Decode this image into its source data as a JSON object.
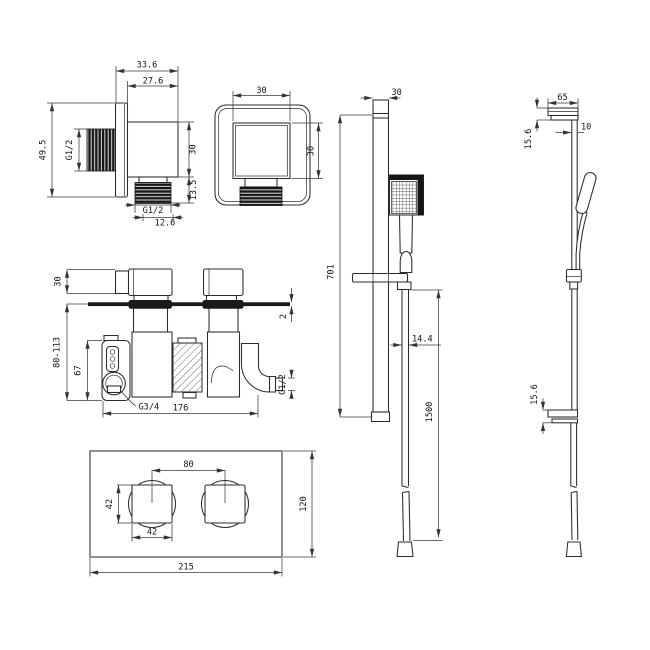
{
  "drawing": {
    "background": "#ffffff",
    "ink": "#2b2b2b",
    "views": {
      "outlet_side": {
        "overall_width": "33.6",
        "body_width": "27.6",
        "flange_height": "49.5",
        "inlet_thread": "G1/2",
        "body_height": "30",
        "thread_length": "13.5",
        "outlet_thread": "G1/2",
        "outlet_core": "12.6"
      },
      "outlet_front": {
        "face_width": "30",
        "face_height": "30"
      },
      "valve": {
        "handle_depth": "30",
        "install_depth": "80-113",
        "body_height": "67",
        "plate_thickness": "2",
        "outlet_thread": "G1/2",
        "inlet_thread": "G3/4",
        "body_width": "176"
      },
      "plate": {
        "handle_spacing": "80",
        "handle_height": "42",
        "handle_width": "42",
        "plate_height": "120",
        "plate_width": "215"
      },
      "rail_front": {
        "rail_width": "30",
        "rail_length": "701",
        "hose_diameter": "14.4",
        "hose_length": "1500"
      },
      "rail_side": {
        "bracket_length": "65",
        "bracket_top_height": "15.6",
        "rail_depth": "10",
        "bracket_bottom_height": "15.6"
      }
    }
  }
}
